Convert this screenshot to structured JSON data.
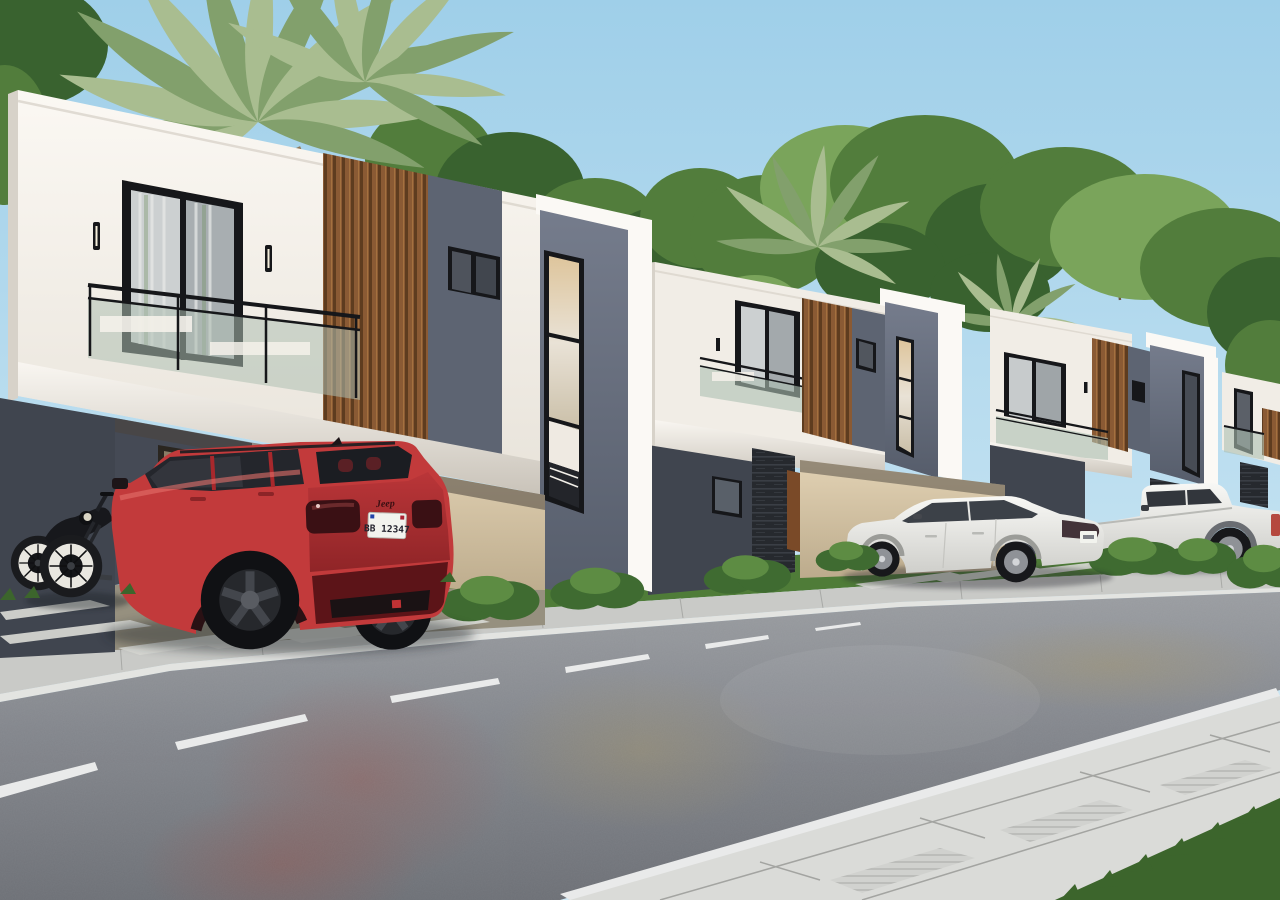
{
  "scene": {
    "type": "3D architectural rendering",
    "description": "Row of four modern two-story townhouses with white parapet frames, glass balconies, vertical wood-slat accent walls and gray stucco stair towers; vehicles parked along a tree-lined asphalt street",
    "time_of_day": "day, clear sky"
  },
  "colors": {
    "sky_top": "#9fcfe9",
    "sky_bottom": "#cfe8f4",
    "tree_dark": "#39622f",
    "tree_mid": "#527d3c",
    "tree_light": "#7aa45b",
    "palm_green": "#a9bd90",
    "palm_dark": "#82a06c",
    "facade_white": "#f1ede6",
    "facade_bright": "#fbf9f5",
    "facade_shadow": "#d7d2c9",
    "wall_dark": "#5d6472",
    "tower_gray": "#6a7181",
    "wall_dark_lower": "#40454f",
    "glass_frame": "#16171a",
    "interior_warm": "#d9bd92",
    "carport_beige": "#d6c5a6",
    "stone_dark": "#2e3138",
    "grass": "#4f7c38",
    "grass_dark": "#3c652c",
    "bush_green": "#3f6b31",
    "bush_light": "#5d8c43",
    "sidewalk": "#c9cac7",
    "sidewalk_bright": "#dadbd8",
    "curb_top": "#e3e4e1",
    "road_near": "#72757b",
    "road_far": "#9a9da1",
    "lane_marking": "#e9eaea",
    "suv_red": "#c23a3b",
    "suv_red_dark": "#8c2427",
    "suv_red_deep": "#63161a",
    "tire_black": "#131417",
    "car_white_top": "#f8f8f5",
    "car_white_low": "#cfcfcb",
    "plate_white": "#f2f3ee",
    "plate_text": "#23232e"
  },
  "buildings": {
    "count": 4,
    "style": "modern duplex townhouse",
    "features": [
      "white parapet frame",
      "balcony with glass railing",
      "black aluminum sliding door",
      "vertical wood-slat accent wall",
      "gray stucco stair tower with tall window",
      "carport",
      "landscaped front yard"
    ]
  },
  "vehicles": {
    "suv": {
      "label": "red SUV",
      "brand_badge": "Jeep",
      "license_plate": "BB 12347",
      "wheels": "black alloy"
    },
    "motorcycle": {
      "label": "black cafe-racer motorcycle",
      "tires": "white-wall"
    },
    "sedan": {
      "label": "white sedan"
    },
    "pickup": {
      "label": "white crew-cab pickup truck"
    }
  },
  "street": {
    "lane_marking": "white dashed centerline",
    "edge_line": "solid white edge line",
    "surfaces": [
      "asphalt road",
      "concrete sidewalk",
      "paver driveway strips",
      "lawn"
    ]
  },
  "vegetation": {
    "palms": 3,
    "bushes": 7,
    "background": "dense green trees"
  }
}
